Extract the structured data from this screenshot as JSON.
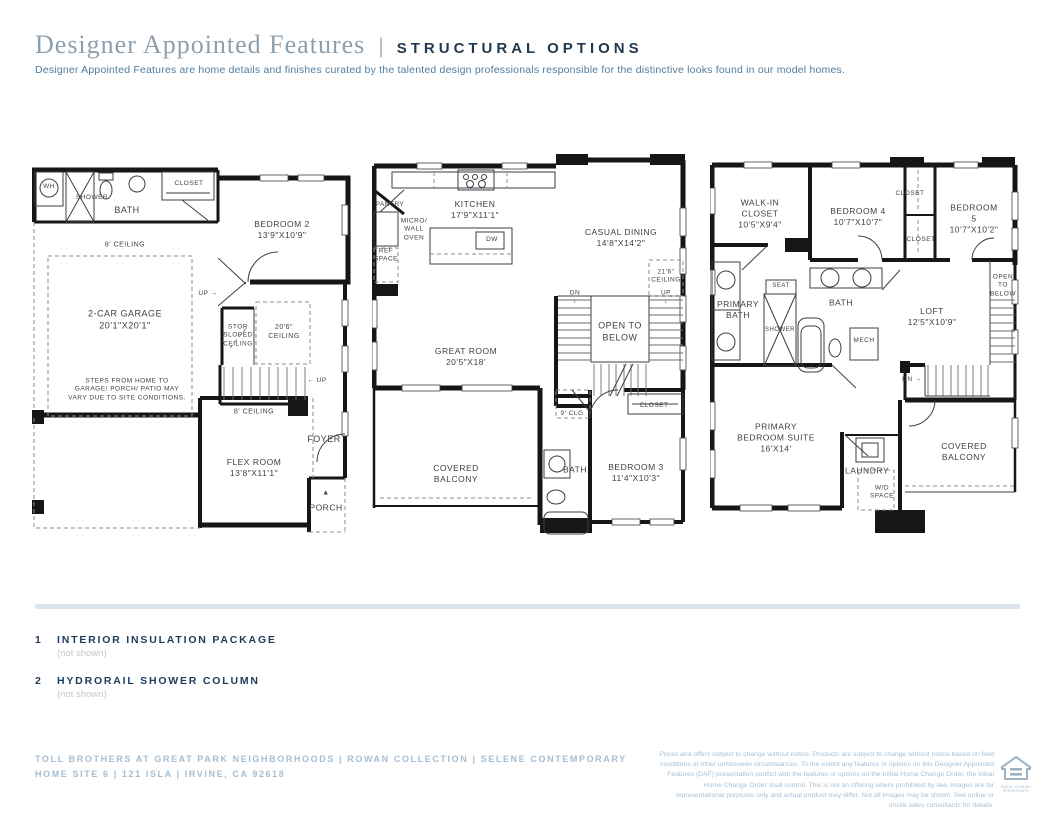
{
  "header": {
    "title": "Designer Appointed Features",
    "separator": "|",
    "subtitle": "STRUCTURAL OPTIONS",
    "description": "Designer Appointed Features are home details and finishes curated by the talented design professionals responsible for the distinctive looks found in our model homes."
  },
  "colors": {
    "accent_navy": "#1d3c5c",
    "title_gray_blue": "#8d9fae",
    "description_blue": "#4f7d9e",
    "footer_blue": "#a6bdd1",
    "wall_black": "#161616",
    "divider": "#dde4ec"
  },
  "plans": [
    {
      "name": "first-floor",
      "labels": [
        {
          "t": "WH"
        },
        {
          "t": "SHOWER"
        },
        {
          "t": "BATH"
        },
        {
          "t": "CLOSET"
        },
        {
          "t": "BEDROOM 2\n13'9\"X10'9\""
        },
        {
          "t": "8' CEILING"
        },
        {
          "t": "2-CAR GARAGE\n20'1\"X20'1\""
        },
        {
          "t": "UP →"
        },
        {
          "t": "STOR\nSLOPED\nCEILING"
        },
        {
          "t": "20'6\"\nCEILING"
        },
        {
          "t": "STEPS FROM HOME TO\nGARAGE/ PORCH/ PATIO MAY\nVARY DUE TO SITE CONDITIONS."
        },
        {
          "t": "← UP"
        },
        {
          "t": "8' CEILING"
        },
        {
          "t": "FOYER"
        },
        {
          "t": "FLEX ROOM\n13'8\"X11'1\""
        },
        {
          "t": "▲"
        },
        {
          "t": "PORCH"
        }
      ]
    },
    {
      "name": "second-floor",
      "labels": [
        {
          "t": "PANTRY"
        },
        {
          "t": "KITCHEN\n17'9\"X11'1\""
        },
        {
          "t": "MICRO/\nWALL\nOVEN"
        },
        {
          "t": "REF\nSPACE"
        },
        {
          "t": "DW"
        },
        {
          "t": "CASUAL DINING\n14'8\"X14'2\""
        },
        {
          "t": "21'6\"\nCEILING"
        },
        {
          "t": "DN\n↓"
        },
        {
          "t": "UP\n↓"
        },
        {
          "t": "OPEN TO\nBELOW"
        },
        {
          "t": "GREAT ROOM\n20'5\"X18'"
        },
        {
          "t": "9' CLG"
        },
        {
          "t": "CLOSET"
        },
        {
          "t": "COVERED\nBALCONY"
        },
        {
          "t": "BATH"
        },
        {
          "t": "BEDROOM 3\n11'4\"X10'3\""
        }
      ]
    },
    {
      "name": "third-floor",
      "labels": [
        {
          "t": "WALK-IN\nCLOSET\n10'5\"X9'4\""
        },
        {
          "t": "BEDROOM 4\n10'7\"X10'7\""
        },
        {
          "t": "CLOSET"
        },
        {
          "t": "BEDROOM 5\n10'7\"X10'2\""
        },
        {
          "t": "CLOSET"
        },
        {
          "t": "PRIMARY\nBATH"
        },
        {
          "t": "SEAT"
        },
        {
          "t": "SHOWER"
        },
        {
          "t": "BATH"
        },
        {
          "t": "MECH"
        },
        {
          "t": "LOFT\n12'5\"X10'9\""
        },
        {
          "t": "OPEN\nTO\nBELOW"
        },
        {
          "t": "DN →"
        },
        {
          "t": "PRIMARY\nBEDROOM SUITE\n16'X14'"
        },
        {
          "t": "LAUNDRY"
        },
        {
          "t": "W/D\nSPACE"
        },
        {
          "t": "COVERED\nBALCONY"
        }
      ]
    }
  ],
  "features": [
    {
      "number": "1",
      "title": "INTERIOR INSULATION PACKAGE",
      "note": "(not shown)"
    },
    {
      "number": "2",
      "title": "HYDRORAIL SHOWER COLUMN",
      "note": "(not shown)"
    }
  ],
  "footer": {
    "line1": "TOLL BROTHERS AT GREAT PARK NEIGHBORHOODS | ROWAN COLLECTION | SELENE CONTEMPORARY",
    "line2": "HOME SITE 6 | 121 ISLA | IRVINE, CA 92618",
    "disclaimer": "Prices and offers subject to change without notice. Products are subject to change without notice based on field conditions or other unforeseen circumstances. To the extent any features or options on this Designer Appointed Features (DAF) presentation conflict with the features or options on the Initial Home Change Order, the Initial Home Change Order shall control. This is not an offering where prohibited by law. Images are for representational purposes only and actual product may differ. Not all images may be shown. See online or onsite sales consultants for details.",
    "logo_label": "EQUAL HOUSING OPPORTUNITY"
  }
}
